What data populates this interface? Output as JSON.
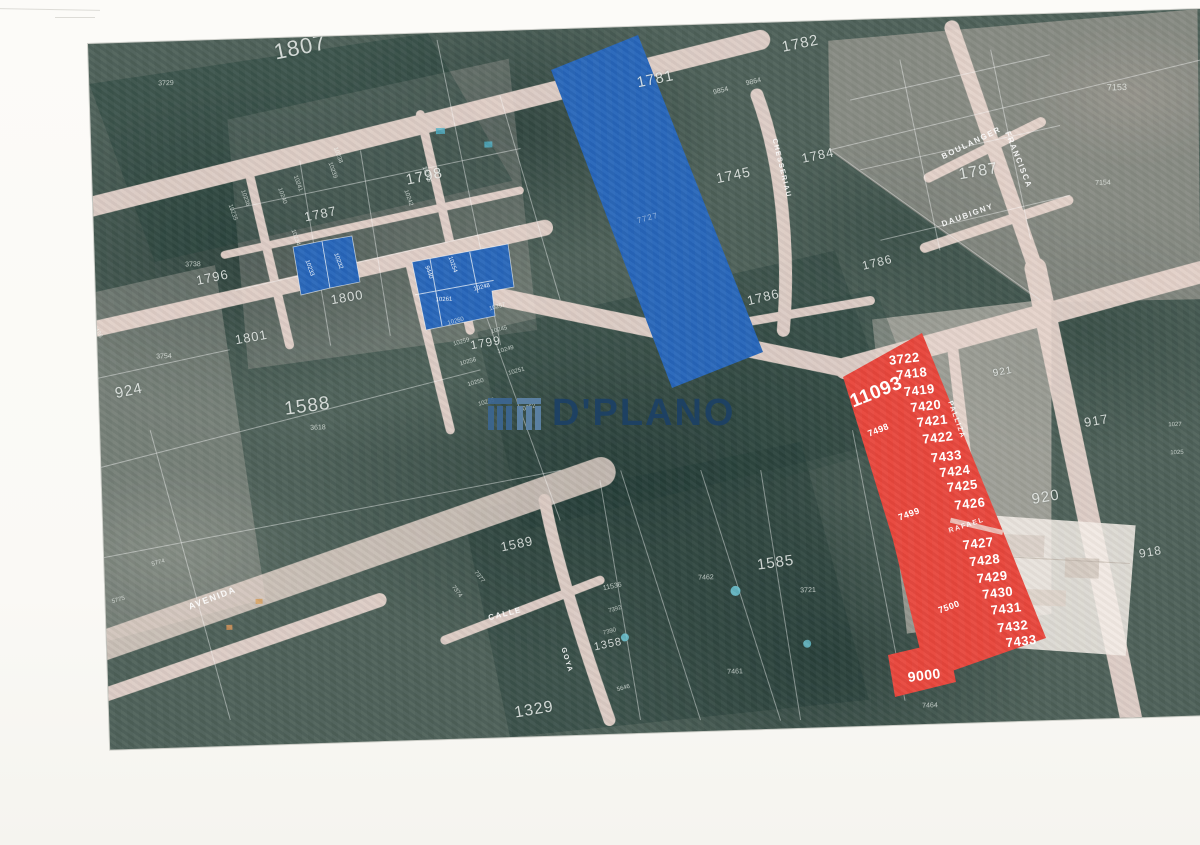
{
  "watermark": {
    "brand": "D'PLANO",
    "color": "#1d4166",
    "logo_dark": "#3c6691",
    "logo_light": "#5e84a9"
  },
  "map": {
    "palette": {
      "highlight_blue": "#2766ba",
      "highlight_red": "#e8463c",
      "road_pink": "#eedad2",
      "forest_green": "#4e6159",
      "page_white": "#fbfaf6",
      "boundary_white": "rgba(255,255,255,0.45)"
    },
    "defaults": {
      "area": 13,
      "street": 8,
      "parcel": 7,
      "red": 13,
      "blue": 6,
      "faint": 8
    },
    "shapes": [
      {
        "name": "highlight-blue-large-lot",
        "fill": "highlight_blue",
        "points": [
          [
            551,
            70
          ],
          [
            638,
            35
          ],
          [
            763,
            352
          ],
          [
            672,
            388
          ]
        ]
      },
      {
        "name": "highlight-red-main-lot",
        "fill": "highlight_red",
        "points": [
          [
            843,
            377
          ],
          [
            922,
            333
          ],
          [
            1000,
            524
          ],
          [
            1046,
            638
          ],
          [
            935,
            677
          ],
          [
            920,
            650
          ],
          [
            893,
            540
          ]
        ]
      },
      {
        "name": "highlight-red-lot-9000",
        "fill": "highlight_red",
        "points": [
          [
            888,
            655
          ],
          [
            948,
            641
          ],
          [
            956,
            682
          ],
          [
            895,
            697
          ]
        ]
      },
      {
        "name": "highlight-blue-parcel-a1",
        "fill": "highlight_blue",
        "stroke": true,
        "points": [
          [
            293,
            247
          ],
          [
            322,
            241
          ],
          [
            330,
            288
          ],
          [
            301,
            295
          ]
        ]
      },
      {
        "name": "highlight-blue-parcel-a2",
        "fill": "highlight_blue",
        "stroke": true,
        "points": [
          [
            322,
            241
          ],
          [
            352,
            236
          ],
          [
            360,
            282
          ],
          [
            330,
            288
          ]
        ]
      },
      {
        "name": "highlight-blue-parcel-b",
        "fill": "highlight_blue",
        "stroke": true,
        "points": [
          [
            412,
            262
          ],
          [
            508,
            244
          ],
          [
            514,
            287
          ],
          [
            492,
            291
          ],
          [
            495,
            316
          ],
          [
            426,
            330
          ]
        ]
      }
    ],
    "labels": [
      {
        "t": "1807",
        "x": 300,
        "y": 47,
        "s": 22,
        "r": -10,
        "k": "area"
      },
      {
        "t": "1798",
        "x": 424,
        "y": 176,
        "s": 15,
        "r": -10,
        "k": "area"
      },
      {
        "t": "1787",
        "x": 320,
        "y": 214,
        "s": 13,
        "r": -10,
        "k": "area"
      },
      {
        "t": "1796",
        "x": 212,
        "y": 277,
        "s": 13,
        "r": -10,
        "k": "area"
      },
      {
        "t": "1801",
        "x": 251,
        "y": 337,
        "s": 13,
        "r": -8,
        "k": "area"
      },
      {
        "t": "1800",
        "x": 347,
        "y": 297,
        "s": 13,
        "r": -8,
        "k": "area"
      },
      {
        "t": "1799",
        "x": 486,
        "y": 343,
        "s": 12,
        "r": -8,
        "k": "area"
      },
      {
        "t": "1588",
        "x": 307,
        "y": 406,
        "s": 19,
        "r": -6,
        "k": "area"
      },
      {
        "t": "924",
        "x": 129,
        "y": 391,
        "s": 15,
        "r": -10,
        "k": "area"
      },
      {
        "t": "1781",
        "x": 655,
        "y": 79,
        "s": 15,
        "r": -10,
        "k": "area"
      },
      {
        "t": "1782",
        "x": 800,
        "y": 44,
        "s": 15,
        "r": -10,
        "k": "area"
      },
      {
        "t": "1745",
        "x": 733,
        "y": 175,
        "s": 14,
        "r": -10,
        "k": "area"
      },
      {
        "t": "1784",
        "x": 818,
        "y": 155,
        "s": 13,
        "r": -10,
        "k": "area"
      },
      {
        "t": "1786",
        "x": 763,
        "y": 297,
        "s": 13,
        "r": -12,
        "k": "area"
      },
      {
        "t": "1786",
        "x": 877,
        "y": 262,
        "s": 12,
        "r": -12,
        "k": "area"
      },
      {
        "t": "1787",
        "x": 978,
        "y": 172,
        "s": 16,
        "r": -8,
        "k": "area"
      },
      {
        "t": "921",
        "x": 1003,
        "y": 372,
        "s": 10,
        "r": -8,
        "k": "area"
      },
      {
        "t": "917",
        "x": 1096,
        "y": 420,
        "s": 13,
        "r": -8,
        "k": "area"
      },
      {
        "t": "920",
        "x": 1046,
        "y": 497,
        "s": 15,
        "r": -8,
        "k": "area"
      },
      {
        "t": "918",
        "x": 1150,
        "y": 552,
        "s": 12,
        "r": -8,
        "k": "area"
      },
      {
        "t": "1585",
        "x": 776,
        "y": 563,
        "s": 15,
        "r": -6,
        "k": "area"
      },
      {
        "t": "1589",
        "x": 517,
        "y": 544,
        "s": 13,
        "r": -10,
        "k": "area"
      },
      {
        "t": "1358",
        "x": 608,
        "y": 645,
        "s": 11,
        "r": -10,
        "k": "area"
      },
      {
        "t": "1329",
        "x": 534,
        "y": 710,
        "s": 16,
        "r": -8,
        "k": "area"
      },
      {
        "t": "3729",
        "x": 166,
        "y": 84,
        "k": "parcel"
      },
      {
        "t": "3754",
        "x": 164,
        "y": 357,
        "k": "parcel"
      },
      {
        "t": "3738",
        "x": 193,
        "y": 265,
        "k": "parcel"
      },
      {
        "t": "3618",
        "x": 318,
        "y": 428,
        "k": "parcel"
      },
      {
        "t": "7153",
        "x": 1117,
        "y": 88,
        "s": 9,
        "k": "parcel"
      },
      {
        "t": "7154",
        "x": 1103,
        "y": 183,
        "k": "parcel"
      },
      {
        "t": "7462",
        "x": 706,
        "y": 578,
        "k": "parcel"
      },
      {
        "t": "3721",
        "x": 808,
        "y": 591,
        "k": "parcel"
      },
      {
        "t": "7461",
        "x": 735,
        "y": 672,
        "k": "parcel"
      },
      {
        "t": "11536",
        "x": 612,
        "y": 587,
        "r": -10,
        "k": "parcel"
      },
      {
        "t": "7464",
        "x": 930,
        "y": 706,
        "k": "parcel"
      },
      {
        "t": "9854",
        "x": 721,
        "y": 91,
        "r": -12,
        "k": "parcel"
      },
      {
        "t": "9864",
        "x": 753,
        "y": 82,
        "r": -12,
        "k": "parcel"
      },
      {
        "t": "10238",
        "x": 338,
        "y": 155,
        "s": 6,
        "r": 72,
        "k": "parcel"
      },
      {
        "t": "10239",
        "x": 332,
        "y": 170,
        "s": 6,
        "r": 72,
        "k": "parcel"
      },
      {
        "t": "10241",
        "x": 297,
        "y": 183,
        "s": 6,
        "r": 72,
        "k": "parcel"
      },
      {
        "t": "10240",
        "x": 282,
        "y": 196,
        "s": 6,
        "r": 72,
        "k": "parcel"
      },
      {
        "t": "10236",
        "x": 245,
        "y": 198,
        "s": 6,
        "r": 72,
        "k": "parcel"
      },
      {
        "t": "10235",
        "x": 232,
        "y": 213,
        "s": 6,
        "r": 72,
        "k": "parcel"
      },
      {
        "t": "10234",
        "x": 295,
        "y": 238,
        "s": 6,
        "r": 72,
        "k": "parcel"
      },
      {
        "t": "10243",
        "x": 426,
        "y": 174,
        "s": 6,
        "r": 72,
        "k": "parcel"
      },
      {
        "t": "10242",
        "x": 408,
        "y": 198,
        "s": 6,
        "r": 72,
        "k": "parcel"
      },
      {
        "t": "10257",
        "x": 497,
        "y": 307,
        "s": 6,
        "r": -14,
        "k": "parcel"
      },
      {
        "t": "10260",
        "x": 456,
        "y": 322,
        "s": 6,
        "r": -14,
        "k": "parcel"
      },
      {
        "t": "10245",
        "x": 499,
        "y": 330,
        "s": 6,
        "r": -14,
        "k": "parcel"
      },
      {
        "t": "10259",
        "x": 461,
        "y": 342,
        "s": 6,
        "r": -14,
        "k": "parcel"
      },
      {
        "t": "10249",
        "x": 506,
        "y": 350,
        "s": 6,
        "r": -14,
        "k": "parcel"
      },
      {
        "t": "10256",
        "x": 468,
        "y": 362,
        "s": 6,
        "r": -14,
        "k": "parcel"
      },
      {
        "t": "10251",
        "x": 516,
        "y": 372,
        "s": 6,
        "r": -14,
        "k": "parcel"
      },
      {
        "t": "10250",
        "x": 476,
        "y": 383,
        "s": 6,
        "r": -14,
        "k": "parcel"
      },
      {
        "t": "10255",
        "x": 486,
        "y": 403,
        "s": 6,
        "r": -14,
        "k": "parcel"
      },
      {
        "t": "10252",
        "x": 528,
        "y": 408,
        "s": 6,
        "r": -14,
        "k": "parcel"
      },
      {
        "t": "7377",
        "x": 479,
        "y": 577,
        "s": 6,
        "r": 55,
        "k": "parcel"
      },
      {
        "t": "7374",
        "x": 456,
        "y": 592,
        "s": 6,
        "r": 55,
        "k": "parcel"
      },
      {
        "t": "7392",
        "x": 615,
        "y": 610,
        "s": 6,
        "r": -14,
        "k": "parcel"
      },
      {
        "t": "7390",
        "x": 610,
        "y": 632,
        "s": 6,
        "r": -14,
        "k": "parcel"
      },
      {
        "t": "5646",
        "x": 623,
        "y": 688,
        "s": 6,
        "r": -14,
        "k": "parcel"
      },
      {
        "t": "1027",
        "x": 1175,
        "y": 425,
        "s": 6,
        "k": "parcel"
      },
      {
        "t": "1025",
        "x": 1177,
        "y": 453,
        "s": 6,
        "k": "parcel"
      },
      {
        "t": "5775",
        "x": 118,
        "y": 600,
        "s": 6,
        "r": -14,
        "k": "parcel"
      },
      {
        "t": "5774",
        "x": 158,
        "y": 563,
        "s": 6,
        "r": -14,
        "k": "parcel"
      },
      {
        "t": "9486",
        "x": 97,
        "y": 332,
        "s": 6,
        "r": 60,
        "k": "parcel"
      },
      {
        "t": "BOULANGER",
        "x": 972,
        "y": 143,
        "r": -24,
        "k": "street"
      },
      {
        "t": "DAUBIGNY",
        "x": 968,
        "y": 215,
        "r": -18,
        "k": "street"
      },
      {
        "t": "FRANCISCA",
        "x": 1018,
        "y": 160,
        "r": 70,
        "k": "street"
      },
      {
        "t": "CHESSERIAU",
        "x": 781,
        "y": 168,
        "s": 7,
        "r": 78,
        "k": "street"
      },
      {
        "t": "PALLIZA",
        "x": 956,
        "y": 420,
        "s": 7,
        "r": 72,
        "k": "street"
      },
      {
        "t": "CALLE",
        "x": 505,
        "y": 614,
        "r": -12,
        "k": "street"
      },
      {
        "t": "AVENIDA",
        "x": 212,
        "y": 598,
        "s": 9,
        "r": -19,
        "k": "street"
      },
      {
        "t": "GOYA",
        "x": 567,
        "y": 660,
        "s": 7,
        "r": 75,
        "k": "street"
      },
      {
        "t": "RAFAEL",
        "x": 967,
        "y": 526,
        "s": 7,
        "r": -16,
        "k": "street"
      },
      {
        "t": "3722",
        "x": 904,
        "y": 358,
        "r": -5,
        "k": "red"
      },
      {
        "t": "7418",
        "x": 912,
        "y": 373,
        "r": -5,
        "k": "red"
      },
      {
        "t": "7419",
        "x": 919,
        "y": 390,
        "r": -5,
        "k": "red"
      },
      {
        "t": "7420",
        "x": 926,
        "y": 406,
        "r": -5,
        "k": "red"
      },
      {
        "t": "7421",
        "x": 932,
        "y": 421,
        "r": -5,
        "k": "red"
      },
      {
        "t": "7422",
        "x": 938,
        "y": 437,
        "r": -5,
        "k": "red"
      },
      {
        "t": "7433",
        "x": 946,
        "y": 456,
        "r": -5,
        "k": "red"
      },
      {
        "t": "7424",
        "x": 955,
        "y": 471,
        "r": -5,
        "k": "red"
      },
      {
        "t": "7425",
        "x": 962,
        "y": 486,
        "r": -5,
        "k": "red"
      },
      {
        "t": "7426",
        "x": 970,
        "y": 503,
        "r": -5,
        "k": "red"
      },
      {
        "t": "7427",
        "x": 978,
        "y": 543,
        "r": -5,
        "k": "red"
      },
      {
        "t": "7428",
        "x": 985,
        "y": 560,
        "r": -5,
        "k": "red"
      },
      {
        "t": "7429",
        "x": 992,
        "y": 577,
        "r": -5,
        "k": "red"
      },
      {
        "t": "7430",
        "x": 998,
        "y": 593,
        "r": -5,
        "k": "red"
      },
      {
        "t": "7431",
        "x": 1006,
        "y": 608,
        "r": -5,
        "k": "red"
      },
      {
        "t": "7432",
        "x": 1013,
        "y": 626,
        "r": -5,
        "k": "red"
      },
      {
        "t": "7433",
        "x": 1021,
        "y": 641,
        "r": -5,
        "k": "red"
      },
      {
        "t": "9000",
        "x": 924,
        "y": 675,
        "s": 14,
        "r": -5,
        "k": "red"
      },
      {
        "t": "11093",
        "x": 876,
        "y": 392,
        "s": 19,
        "r": -20,
        "k": "red"
      },
      {
        "t": "7498",
        "x": 878,
        "y": 430,
        "s": 9,
        "r": -20,
        "k": "red"
      },
      {
        "t": "7499",
        "x": 909,
        "y": 514,
        "s": 9,
        "r": -18,
        "k": "red"
      },
      {
        "t": "7500",
        "x": 949,
        "y": 607,
        "s": 9,
        "r": -18,
        "k": "red"
      },
      {
        "t": "10233",
        "x": 309,
        "y": 268,
        "r": 72,
        "k": "blue"
      },
      {
        "t": "10232",
        "x": 338,
        "y": 261,
        "r": 72,
        "k": "blue"
      },
      {
        "t": "9440",
        "x": 428,
        "y": 272,
        "r": 72,
        "k": "blue"
      },
      {
        "t": "10254",
        "x": 452,
        "y": 265,
        "r": 72,
        "k": "blue"
      },
      {
        "t": "10261",
        "x": 444,
        "y": 300,
        "k": "blue"
      },
      {
        "t": "10248",
        "x": 482,
        "y": 288,
        "r": -12,
        "k": "blue"
      },
      {
        "t": "7727",
        "x": 648,
        "y": 218,
        "r": -14,
        "k": "faint"
      }
    ]
  }
}
